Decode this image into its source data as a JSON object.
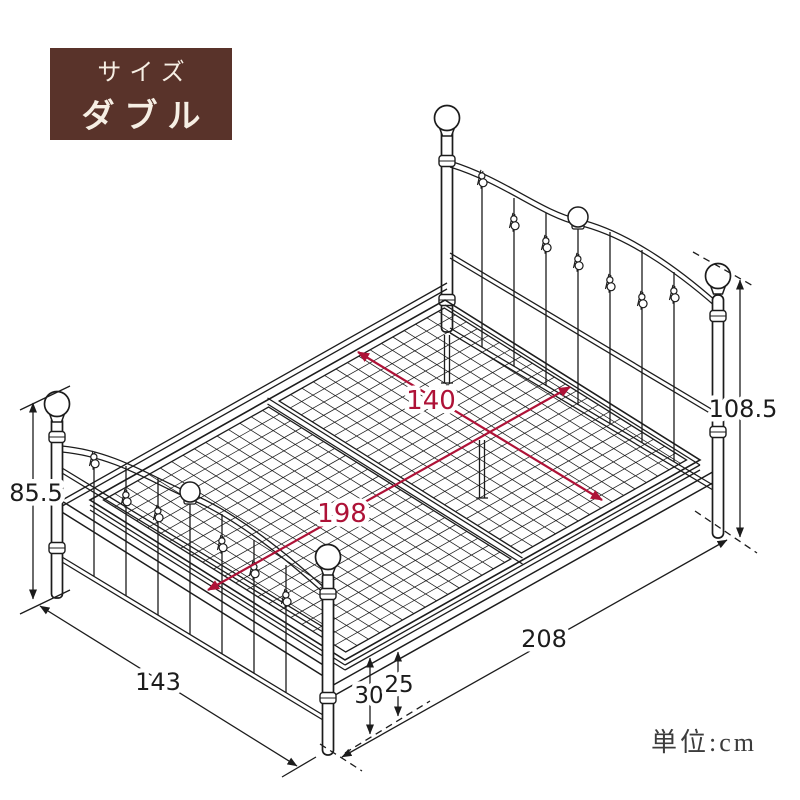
{
  "badge": {
    "label": "サイズ",
    "value": "ダブル"
  },
  "unit_note": "単位:cm",
  "dimensions": {
    "headboard_height": "108.5",
    "footboard_height": "85.5",
    "total_length": "208",
    "total_width": "143",
    "frame_top_height": "30",
    "under_clearance": "25",
    "inner_width": "140",
    "inner_length": "198"
  },
  "colors": {
    "ink": "#1c1c1c",
    "accent_red": "#ae1237",
    "badge_bg": "#59332a",
    "badge_fg": "#f6efe4"
  }
}
